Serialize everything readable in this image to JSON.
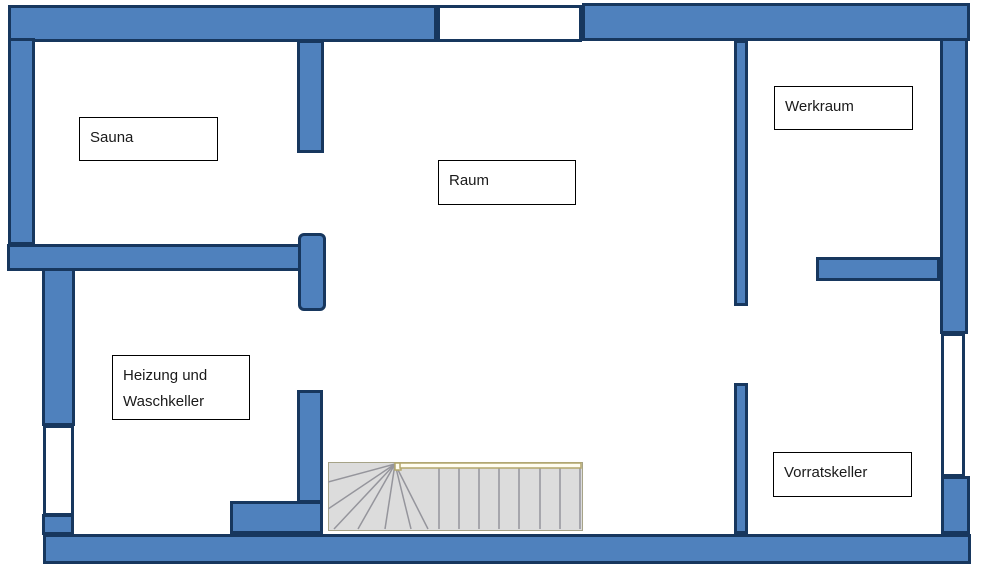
{
  "document": {
    "type": "basement-floor-plan",
    "background": "#ffffff"
  },
  "colors": {
    "wall_fill": "#4f81bd",
    "wall_border": "#17375e",
    "window_fill": "#ffffff",
    "stair_fill": "#dcdcdc",
    "stair_tread_line": "#95959c",
    "stair_outline": "#a6a388",
    "handrail": "#b3a76c",
    "label_border": "#000000",
    "label_text": "#1a1a1a"
  },
  "rooms": {
    "sauna": {
      "label": "Sauna"
    },
    "raum": {
      "label": "Raum"
    },
    "werkraum": {
      "label": "Werkraum"
    },
    "heizung": {
      "line1": "Heizung und",
      "line2": "Waschkeller"
    },
    "vorratskeller": {
      "label": "Vorratskeller"
    }
  }
}
